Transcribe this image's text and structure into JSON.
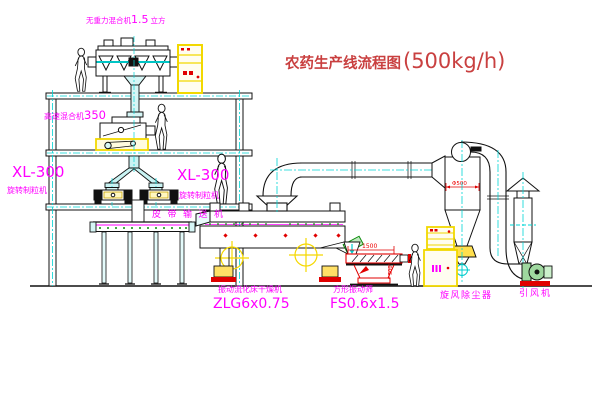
{
  "title": {
    "main": "农药生产线流程图",
    "capacity": "(500kg/h)"
  },
  "labels": {
    "zero_gravity_mixer": {
      "prefix": "无重力混合机",
      "size": "1.5",
      "suffix": "立方"
    },
    "high_speed_mixer": {
      "prefix": "高速混合机",
      "size": "350"
    },
    "granulator_left": {
      "model": "XL-300",
      "name": "旋转制粒机"
    },
    "granulator_center": {
      "model": "XL-300",
      "name": "旋转制粒机"
    },
    "belt_conveyor": "皮带输送机",
    "fluid_bed_dryer": {
      "name": "振动流化床干燥机",
      "model": "ZLG6x0.75"
    },
    "square_sieve": {
      "name": "方形振动筛",
      "model": "FS0.6x1.5"
    },
    "cyclone": "旋风除尘器",
    "induced_draft_fan": "引风机"
  },
  "dimensions": {
    "cyclone_diameter": "Φ500",
    "sieve_length": "1500",
    "sieve_outlet_height": "500"
  },
  "colors": {
    "label_magenta": "#ff00ff",
    "title_red": "#c94040",
    "dimension_red": "#ee0000",
    "line_black": "#111111",
    "centerline_cyan": "#00d5d5",
    "equipment_yellow": "#f2d800"
  }
}
